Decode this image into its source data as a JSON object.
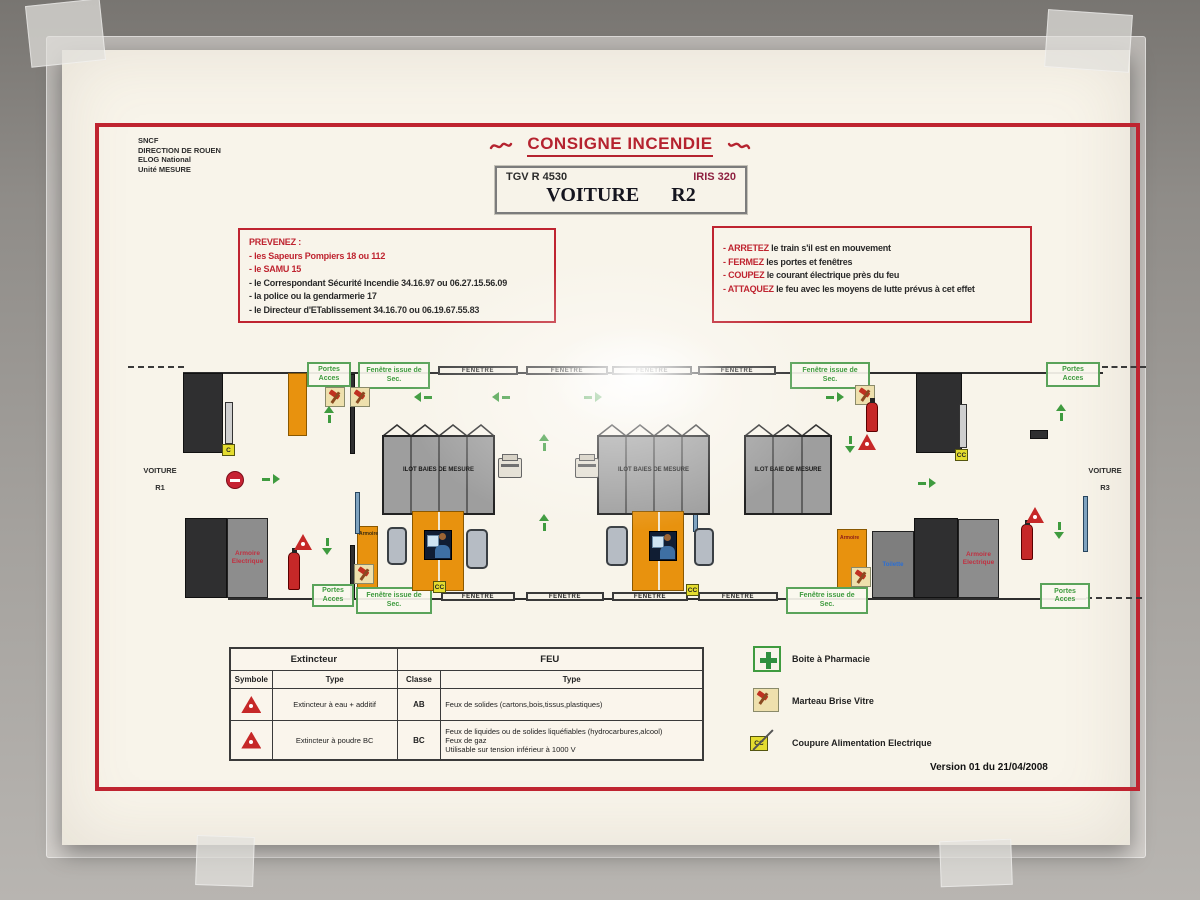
{
  "org": {
    "lines": [
      "SNCF",
      "DIRECTION DE ROUEN",
      "ELOG National",
      "Unité MESURE"
    ]
  },
  "title": "CONSIGNE INCENDIE",
  "train_box": {
    "id": "TGV R  4530",
    "name": "IRIS 320",
    "car_word": "VOITURE",
    "car_number": "R2"
  },
  "prevenez": {
    "title": "PREVENEZ :",
    "items": [
      "- les Sapeurs Pompiers 18 ou 112",
      "- le SAMU 15",
      "- le Correspondant Sécurité Incendie 34.16.97 ou 06.27.15.56.09",
      "- la police ou la gendarmerie 17",
      "- le Directeur d'ETablissement 34.16.70 ou 06.19.67.55.83"
    ]
  },
  "actions": {
    "items": [
      {
        "keyword": "- ARRETEZ",
        "rest": " le train s'il est en mouvement"
      },
      {
        "keyword": "- FERMEZ",
        "rest": " les portes et fenêtres"
      },
      {
        "keyword": "- COUPEZ",
        "rest": " le courant électrique près du feu"
      },
      {
        "keyword": "- ATTAQUEZ",
        "rest": " le feu avec les moyens de lutte prévus à cet effet"
      }
    ]
  },
  "diagram": {
    "voiture": "VOITURE",
    "r1": "R1",
    "r3": "R3",
    "portes_line1": "Portes",
    "portes_line2": "Acces",
    "fi_line1": "Fenêtre issue de",
    "fi_line2": "Sec.",
    "fenetre": "FENETRE",
    "ilot_baies": "ILOT BAIES DE MESURE",
    "ilot_baie": "ILOT BAIE DE MESURE",
    "armoire": "Armoire",
    "ae_line1": "Armoire",
    "ae_line2": "Electrique",
    "toilette": "Toilette",
    "c_label": "C",
    "cc_label": "CC"
  },
  "table": {
    "extincteur": "Extincteur",
    "feu": "FEU",
    "symbole": "Symbole",
    "type": "Type",
    "classe": "Classe",
    "type2": "Type",
    "row1": {
      "type": "Extincteur à eau + additif",
      "classe": "AB",
      "feu": "Feux de solides (cartons,bois,tissus,plastiques)"
    },
    "row2": {
      "type": "Extincteur à poudre BC",
      "classe": "BC",
      "feu1": "Feux de liquides ou de solides liquéfiables (hydrocarbures,alcool)",
      "feu2": "Feux de gaz",
      "feu3": "Utilisable sur tension inférieur à 1000 V"
    }
  },
  "legend": {
    "pharmacie": "Boite à Pharmacie",
    "marteau": "Marteau Brise Vitre",
    "coupure": "Coupure Alimentation Electrique"
  },
  "footer": {
    "version": "Version 01 du 21/04/2008"
  },
  "colors": {
    "frame_red": "#bf2430",
    "green": "#3f9b3f",
    "orange": "#e8920e",
    "maroon": "#8e2040"
  }
}
